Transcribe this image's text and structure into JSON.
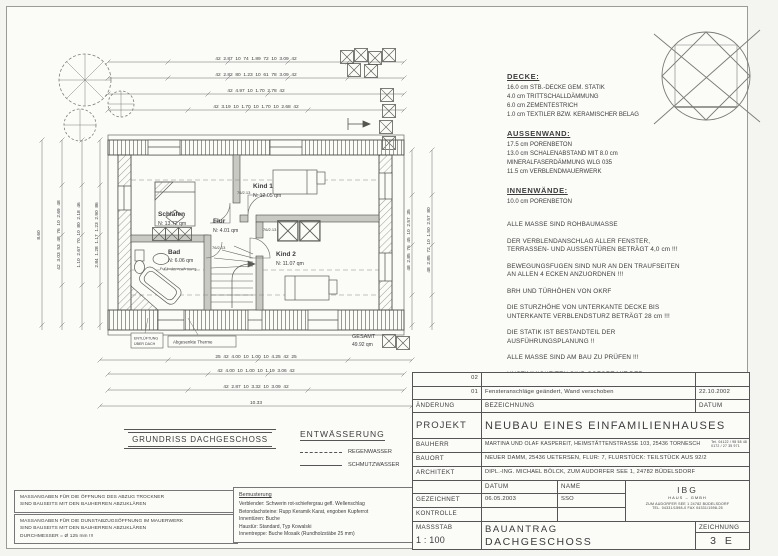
{
  "colors": {
    "paper": "#fbfbf8",
    "ink": "#3c3c3c",
    "line": "#555555"
  },
  "specs": {
    "decke_title": "DECKE:",
    "decke_lines": "16.0 cm STB.-DECKE GEM. STATIK\n4.0 cm TRITTSCHALLDÄMMUNG\n6.0 cm ZEMENTESTRICH\n1.0 cm TEXTILER BZW. KERAMISCHER BELAG",
    "aussenwand_title": "AUSSENWAND:",
    "aussenwand_lines": "17.5 cm PORENBETON\n13.0 cm SCHALENABSTAND MIT 8.0 cm\n         MINERALFASERDÄMMUNG WLG 035\n11.5 cm VERBLENDMAUERWERK",
    "innenwaende_title": "INNENWÄNDE:",
    "innenwaende_lines": "10.0 cm PORENBETON",
    "notes": [
      "ALLE MASSE SIND ROHBAUMASSE",
      "DER VERBLENDANSCHLAG ALLER FENSTER,\nTERRASSEN- UND AUSSENTÜREN BETRÄGT 4,0 cm !!!",
      "BEWEGUNGSFUGEN SIND NUR AN DEN TRAUFSEITEN\nAN ALLEN 4 ECKEN ANZUORDNEN !!!",
      "BRH UND TÜRHÖHEN VON OKRF",
      "DIE STURZHÖHE VON UNTERKANTE DECKE BIS\nUNTERKANTE VERBLENDSTURZ BETRÄGT 28 cm !!!",
      "DIE STATIK IST BESTANDTEIL DER\nAUSFÜHRUNGSPLANUNG !!",
      "ALLE MASSE SIND AM BAU ZU PRÜFEN !!!",
      "UNSTIMMIGKEITEN SIND SOFORT MIT DER\nBAULEITUNG ABZUSTIMMEN !!!"
    ]
  },
  "plan": {
    "rooms": {
      "schlafen": {
        "name": "Schlafen",
        "area": "N: 13.72 qm"
      },
      "kind1": {
        "name": "Kind 1",
        "area": "N: 12.05 qm"
      },
      "kind2": {
        "name": "Kind 2",
        "area": "N: 11.07 qm"
      },
      "bad": {
        "name": "Bad",
        "area": "N: 6.06 qm",
        "note": "Fußbodenerwärmung"
      },
      "flur": {
        "name": "Flur",
        "area": "N: 4.01 qm"
      }
    },
    "gesamt": {
      "label": "GESAMT",
      "value": "49.92 qm"
    },
    "callouts": {
      "vent_line1": "ENTLÜFTUNG",
      "vent_line2": "ÜBER DACH",
      "therme": "Abgesenkte Therme"
    },
    "door_label": "76/2.13",
    "dims": {
      "top": [
        "42  2.87  10  74  1.89  72  10  3.09  42",
        "42  2.82  80  1.23  10  61  78  3.09  42",
        "42  4.97  10  1.70  2.78  42",
        "42  3.19  10  1.70  10  1.70  10  2.68  42"
      ],
      "bottom": [
        "25  42  4.00  10  1.00  10  4.25  42  25",
        "42  4.00  10  1.00  10  1.19  3.06  42",
        "42  2.87  10  3.32  10  3.09  42",
        "10.33"
      ],
      "left": [
        "8.60",
        "42  3.03  53  48  76  10  2.69  48",
        "1.10  2.67  70  10  80  2.18  46",
        "2.84  1.28  1.17  1.23  2.90  86"
      ],
      "right": [
        "48  2.85  76  45  10  2.57  35",
        "48  2.85  72  10  1.50  2.57  80"
      ]
    }
  },
  "drawing_title": "GRUNDRISS DACHGESCHOSS",
  "entwaesserung": {
    "title": "ENTWÄSSERUNG",
    "rain": "REGENWASSER",
    "waste": "SCHMUTZWASSER"
  },
  "site_notes": [
    "MASSANGABEN FÜR DIE ÖFFNUNG DES ABZUG TROCKNER\nSIND BAUSEITS MIT DEN BAUHERREN ABZUKLÄREN",
    "MASSANGABEN FÜR DIE DUNSTABZUGSÖFFNUNG IM MAUERWERK\nSIND BAUSEITS MIT DEN BAUHERREN ABZUKLÄREN\nDURCHMESSER = Ø 125 mm !!!"
  ],
  "bemusterung": {
    "title": "Bemusterung",
    "lines": "Verblender: Schwerin rot-schiefergrau gefl. Wellenschlag\nBetondachsteine: Rupp Keramik Karat, engoben Kupferrot\nInnentüren: Buche\nHaustür: Standard, Typ Kowalski\nInnentreppe: Buche Mosaik (Rundholzstäbe 25 mm)"
  },
  "titleblock": {
    "revisions": [
      {
        "nr": "02",
        "text": "",
        "date": ""
      },
      {
        "nr": "01",
        "text": "Fensteranschläge geändert, Wand verschoben",
        "date": "22.10.2002"
      }
    ],
    "rev_header": {
      "aenderung": "ÄNDERUNG",
      "bezeichnung": "BEZEICHNUNG",
      "datum": "DATUM"
    },
    "projekt_label": "PROJEKT",
    "projekt": "NEUBAU EINES EINFAMILIENHAUSES",
    "bauherr_label": "BAUHERR",
    "bauherr": "MARTINA UND OLAF KASPEREIT, HEIMSTÄTTENSTRASSE 103, 25436 TORNESCH",
    "bauherr_tel": "Tel. 04122 / 98 58 48\n0172 / 27 35 971",
    "bauort_label": "BAUORT",
    "bauort": "NEUER DAMM, 25436 UETERSEN, FLUR: 7, FLURSTÜCK: TEILSTÜCK AUS 92/2",
    "architekt_label": "ARCHITEKT",
    "architekt": "DIPL.-ING. MICHAEL BÖLCK, ZUM AUDORFER SEE 1, 24782 BÜDELSDORF",
    "datum_header": "DATUM",
    "name_header": "NAME",
    "gezeichnet_label": "GEZEICHNET",
    "gezeichnet_datum": "06.05.2003",
    "gezeichnet_name": "SSO",
    "kontrolle_label": "KONTROLLE",
    "firma": {
      "name": "IBG",
      "sub": "HAUS  –  GMBH",
      "addr": "ZUM AUDORFER SEE 1      24782 BÜDELSDORF",
      "tel": "TEL. 04331/1598-0      FAX 04331/1598-25"
    },
    "massstab_label": "MASSSTAB",
    "massstab": "1 : 100",
    "phase": "BAUANTRAG",
    "blatt": "DACHGESCHOSS",
    "zeichnung_label": "ZEICHNUNG",
    "zeichnung_nr": "3 E"
  }
}
